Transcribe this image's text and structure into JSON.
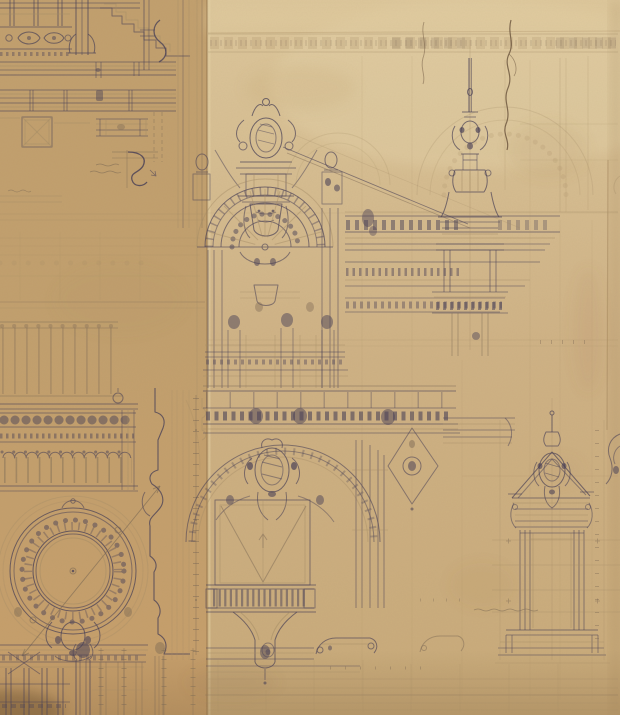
{
  "artwork": {
    "title": "Architectural drawing — ornate Beaux-Arts facade studies in ink and graphite on aged paper",
    "description": "Two overlapping sheets of toned drafting paper covered with orthographic studies: cornice and moulding details, a sculpted crest over a semicircular arched pediment, a tall lantern finial, long entablatures with roof diagonals, an ornamented oculus window over a mullioned window, a balconied niche on a corbel, and a pedimented doorway aedicule. No legible lettering; only illegible pencil notes and dimension ticks.",
    "sheet_count": 2,
    "legible_text": "none"
  },
  "colors": {
    "paperBase": "#cdb183",
    "paperLeft": "#c2a06e",
    "paperLeftBottom": "#c79f6b",
    "paperLight": "#ddc79b",
    "paperMid": "#cfb285",
    "paperShadow": "#8a6a42",
    "ink": "#4a4157",
    "graphite": "#7d6a55",
    "faint": "#a48c66",
    "stain": "#a67f4e",
    "crack": "#5f4833"
  },
  "elements": [
    {
      "id": "top-left-moulding-details",
      "label": "cornice and frieze moulding studies"
    },
    {
      "id": "moulding-profile-sketch",
      "label": "ogee moulding profile with pencil note"
    },
    {
      "id": "roof-cresting",
      "label": "cresting balustrade with ball finial"
    },
    {
      "id": "corbel-table-cornice",
      "label": "rosette frieze and arched corbel table"
    },
    {
      "id": "oculus-window",
      "label": "ornamented circular oculus window with diagonal dimension line"
    },
    {
      "id": "window-mullions",
      "label": "mullioned window with Corinthian capitals"
    },
    {
      "id": "section-profile",
      "label": "vertical wall section profile with tick dimensions"
    },
    {
      "id": "central-crest",
      "label": "sculpted crest cartouche with figures"
    },
    {
      "id": "arched-pediment",
      "label": "semicircular arch with radiating voussoirs and keystone mask"
    },
    {
      "id": "main-entablature",
      "label": "modillioned entablature bands"
    },
    {
      "id": "roof-diagonals",
      "label": "diagonal roof construction lines"
    },
    {
      "id": "lantern-finial",
      "label": "tall domed lantern finial"
    },
    {
      "id": "ghost-frieze-band",
      "label": "faint repeating square frieze and ghost arches"
    },
    {
      "id": "crack-mark",
      "label": "dark wavy crack-like mark"
    },
    {
      "id": "balcony-entablature",
      "label": "balcony slab with ornamented band"
    },
    {
      "id": "lower-arch",
      "label": "great arch with rich spandrel cartouche"
    },
    {
      "id": "niche-balcony",
      "label": "niche with balustraded balcony on carved corbel"
    },
    {
      "id": "pediment-doorway",
      "label": "pedimented doorway aedicule with cartouche"
    },
    {
      "id": "right-edge-ornament",
      "label": "partial scroll ornament cut by sheet edge"
    },
    {
      "id": "pencil-notes",
      "label": "illegible handwritten pencil notes"
    }
  ],
  "annotations": {
    "pencil_note_count": 3,
    "legible": false,
    "dimension_marks": "tick strings and small circled points"
  }
}
